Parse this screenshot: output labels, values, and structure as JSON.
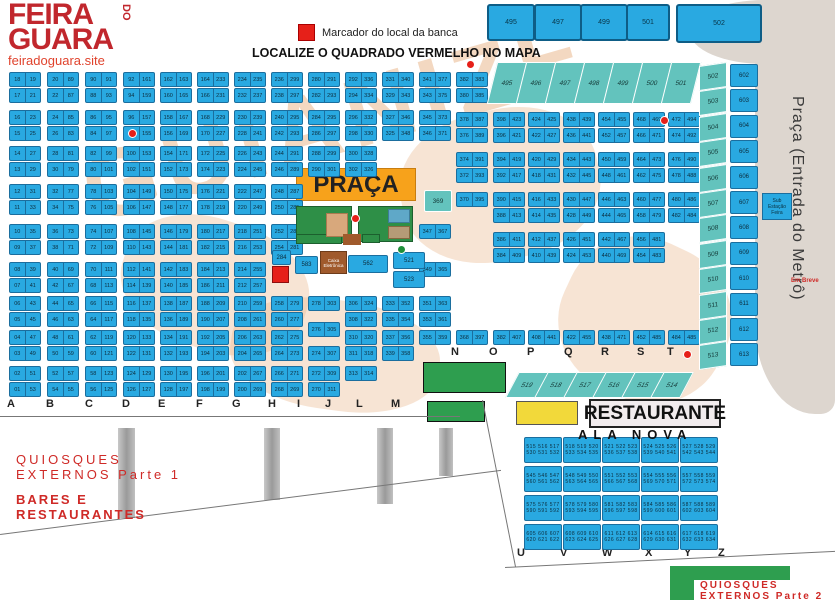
{
  "header": {
    "logo_line1": "FEIRA",
    "logo_do": "DO",
    "logo_line2": "GUARA",
    "site": "feiradoguara.site",
    "legend_label": "Marcador do local da banca",
    "title": "LOCALIZE O QUADRADO VERMELHO NO MAPA"
  },
  "colors": {
    "stall_blue": "#29a9e1",
    "teal": "#63c3bd",
    "orange": "#f7a21b",
    "green": "#2e9e4f",
    "yellow": "#f2d93a",
    "marker_red": "#e62019",
    "brown": "#a05a2c",
    "metro_gray": "#ddd6cf",
    "watermark_tan": "#e9b88e",
    "label_red": "#cf2a27"
  },
  "top_squares": [
    {
      "label": "495",
      "x": 487,
      "y": 4,
      "w": 44,
      "h": 33
    },
    {
      "label": "497",
      "x": 534,
      "y": 4,
      "w": 44,
      "h": 33
    },
    {
      "label": "499",
      "x": 580,
      "y": 4,
      "w": 44,
      "h": 33
    },
    {
      "label": "501",
      "x": 626,
      "y": 4,
      "w": 40,
      "h": 33
    },
    {
      "label": "502",
      "x": 676,
      "y": 4,
      "w": 82,
      "h": 35
    }
  ],
  "rows_y_left": [
    72,
    88,
    110,
    126,
    146,
    162,
    184,
    200,
    224,
    240,
    262,
    278,
    296,
    312,
    330,
    346,
    366,
    382
  ],
  "serpentine_columns": [
    {
      "name": "A",
      "x": 9,
      "left": {
        "from": 18,
        "step": -1
      },
      "right": {
        "from": 19,
        "step": 2
      }
    },
    {
      "name": "B",
      "x": 47,
      "left": {
        "from": 20,
        "step": 2
      },
      "right": {
        "from": 89,
        "step": -2
      }
    },
    {
      "name": "C",
      "x": 85,
      "left": {
        "from": 90,
        "step": -2
      },
      "right": {
        "from": 91,
        "step": 2
      }
    },
    {
      "name": "D",
      "x": 123,
      "left": {
        "from": 92,
        "step": 2
      },
      "right": {
        "from": 161,
        "step": -2
      }
    },
    {
      "name": "E",
      "x": 160,
      "left": {
        "from": 162,
        "step": -2
      },
      "right": {
        "from": 163,
        "step": 2
      }
    },
    {
      "name": "F",
      "x": 197,
      "left": {
        "from": 164,
        "step": 2
      },
      "right": {
        "from": 233,
        "step": -2
      }
    },
    {
      "name": "G",
      "x": 234,
      "left": {
        "from": 234,
        "step": -2
      },
      "right": {
        "from": 235,
        "step": 2
      }
    }
  ],
  "irregular_columns": [
    {
      "name": "H",
      "x": 271,
      "rows": [
        [
          72,
          "236",
          "299"
        ],
        [
          88,
          "238",
          "297"
        ],
        [
          110,
          "240",
          "295"
        ],
        [
          126,
          "242",
          "293"
        ],
        [
          146,
          "244",
          "291"
        ],
        [
          162,
          "246",
          "289"
        ],
        [
          184,
          "248",
          "287"
        ],
        [
          200,
          "250",
          "285"
        ],
        [
          224,
          "252",
          "283"
        ],
        [
          240,
          "254",
          "281"
        ],
        [
          296,
          "258",
          "279"
        ],
        [
          312,
          "260",
          "277"
        ],
        [
          330,
          "262",
          "275"
        ],
        [
          346,
          "264",
          "273"
        ],
        [
          366,
          "266",
          "271"
        ],
        [
          382,
          "268",
          "269"
        ]
      ]
    },
    {
      "name": "I",
      "x": 308,
      "rows": [
        [
          72,
          "280",
          "291"
        ],
        [
          88,
          "282",
          "293"
        ],
        [
          110,
          "284",
          "295"
        ],
        [
          126,
          "286",
          "297"
        ],
        [
          146,
          "288",
          "299"
        ],
        [
          162,
          "290",
          "301"
        ],
        [
          296,
          "278",
          "303"
        ],
        [
          322,
          "276",
          "305"
        ],
        [
          346,
          "274",
          "307"
        ],
        [
          366,
          "272",
          "309"
        ],
        [
          382,
          "270",
          "311"
        ]
      ]
    },
    {
      "name": "J",
      "x": 345,
      "rows": [
        [
          72,
          "292",
          "336"
        ],
        [
          88,
          "294",
          "334"
        ],
        [
          110,
          "296",
          "332"
        ],
        [
          126,
          "298",
          "330"
        ],
        [
          146,
          "300",
          "328"
        ],
        [
          162,
          "302",
          "326"
        ],
        [
          296,
          "306",
          "324"
        ],
        [
          312,
          "308",
          "322"
        ],
        [
          330,
          "310",
          "320"
        ],
        [
          346,
          "311",
          "318"
        ],
        [
          366,
          "313",
          "314"
        ]
      ]
    },
    {
      "name": "L",
      "x": 382,
      "rows": [
        [
          72,
          "331",
          "340"
        ],
        [
          88,
          "329",
          "343"
        ],
        [
          110,
          "327",
          "346"
        ],
        [
          126,
          "325",
          "348"
        ],
        [
          296,
          "333",
          "352"
        ],
        [
          312,
          "335",
          "354"
        ],
        [
          330,
          "337",
          "356"
        ],
        [
          346,
          "339",
          "358"
        ]
      ]
    },
    {
      "name": "M",
      "x": 419,
      "rows": [
        [
          72,
          "341",
          "377"
        ],
        [
          88,
          "343",
          "375"
        ],
        [
          110,
          "345",
          "373"
        ],
        [
          126,
          "346",
          "371"
        ],
        [
          224,
          "347",
          "367"
        ],
        [
          262,
          "349",
          "365"
        ],
        [
          296,
          "351",
          "363"
        ],
        [
          312,
          "353",
          "361"
        ],
        [
          330,
          "355",
          "359"
        ]
      ]
    },
    {
      "name": "N",
      "x": 456,
      "rows": [
        [
          72,
          "382",
          "383"
        ],
        [
          88,
          "380",
          "385"
        ],
        [
          112,
          "378",
          "387"
        ],
        [
          128,
          "376",
          "389"
        ],
        [
          152,
          "374",
          "391"
        ],
        [
          168,
          "372",
          "393"
        ],
        [
          192,
          "370",
          "395"
        ],
        [
          330,
          "368",
          "397"
        ]
      ]
    },
    {
      "name": "O",
      "x": 493,
      "rows": [
        [
          112,
          "398",
          "423"
        ],
        [
          128,
          "396",
          "421"
        ],
        [
          152,
          "394",
          "419"
        ],
        [
          168,
          "392",
          "417"
        ],
        [
          192,
          "390",
          "415"
        ],
        [
          208,
          "388",
          "413"
        ],
        [
          232,
          "386",
          "411"
        ],
        [
          248,
          "384",
          "409"
        ],
        [
          330,
          "382",
          "407"
        ]
      ]
    },
    {
      "name": "P",
      "x": 528,
      "rows": [
        [
          112,
          "424",
          "425"
        ],
        [
          128,
          "422",
          "427"
        ],
        [
          152,
          "420",
          "429"
        ],
        [
          168,
          "418",
          "431"
        ],
        [
          192,
          "416",
          "433"
        ],
        [
          208,
          "414",
          "435"
        ],
        [
          232,
          "412",
          "437"
        ],
        [
          248,
          "410",
          "439"
        ],
        [
          330,
          "408",
          "441"
        ]
      ]
    },
    {
      "name": "Q",
      "x": 563,
      "rows": [
        [
          112,
          "438",
          "439"
        ],
        [
          128,
          "436",
          "441"
        ],
        [
          152,
          "434",
          "443"
        ],
        [
          168,
          "432",
          "445"
        ],
        [
          192,
          "430",
          "447"
        ],
        [
          208,
          "428",
          "449"
        ],
        [
          232,
          "426",
          "451"
        ],
        [
          248,
          "424",
          "453"
        ],
        [
          330,
          "422",
          "455"
        ]
      ]
    },
    {
      "name": "R",
      "x": 598,
      "rows": [
        [
          112,
          "454",
          "455"
        ],
        [
          128,
          "452",
          "457"
        ],
        [
          152,
          "450",
          "459"
        ],
        [
          168,
          "448",
          "461"
        ],
        [
          192,
          "446",
          "463"
        ],
        [
          208,
          "444",
          "465"
        ],
        [
          232,
          "442",
          "467"
        ],
        [
          248,
          "440",
          "469"
        ],
        [
          330,
          "438",
          "471"
        ]
      ]
    },
    {
      "name": "S",
      "x": 633,
      "rows": [
        [
          112,
          "468",
          "469"
        ],
        [
          128,
          "466",
          "471"
        ],
        [
          152,
          "464",
          "473"
        ],
        [
          168,
          "462",
          "475"
        ],
        [
          192,
          "460",
          "477"
        ],
        [
          208,
          "458",
          "479"
        ],
        [
          232,
          "456",
          "481"
        ],
        [
          248,
          "454",
          "483"
        ],
        [
          330,
          "452",
          "485"
        ]
      ]
    },
    {
      "name": "T",
      "x": 668,
      "rows": [
        [
          112,
          "472",
          "494"
        ],
        [
          128,
          "474",
          "492"
        ],
        [
          152,
          "476",
          "490"
        ],
        [
          168,
          "478",
          "488"
        ],
        [
          192,
          "480",
          "486"
        ],
        [
          208,
          "482",
          "484"
        ],
        [
          330,
          "484",
          "485"
        ]
      ]
    }
  ],
  "singles": [
    {
      "label": "284",
      "x": 272,
      "y": 250,
      "w": 19,
      "h": 15,
      "kind": "blue"
    },
    {
      "label": "369",
      "x": 424,
      "y": 190,
      "w": 26,
      "h": 20,
      "kind": "teal"
    },
    {
      "label": "583",
      "x": 295,
      "y": 256,
      "w": 23,
      "h": 18,
      "kind": "blue"
    },
    {
      "label": "562",
      "x": 348,
      "y": 255,
      "w": 40,
      "h": 18,
      "kind": "blue"
    },
    {
      "label": "521",
      "x": 393,
      "y": 252,
      "w": 32,
      "h": 17,
      "kind": "blue"
    },
    {
      "label": "523",
      "x": 393,
      "y": 271,
      "w": 32,
      "h": 17,
      "kind": "blue"
    }
  ],
  "red_square_marker": {
    "x": 272,
    "y": 266,
    "w": 17,
    "h": 17
  },
  "praca": {
    "label": "PRAÇA",
    "box": {
      "x": 296,
      "y": 168,
      "w": 120,
      "h": 33
    },
    "green_boxes": [
      {
        "x": 296,
        "y": 206,
        "w": 56,
        "h": 37
      },
      {
        "x": 358,
        "y": 206,
        "w": 55,
        "h": 36
      },
      {
        "x": 296,
        "y": 234,
        "w": 46,
        "h": 10
      },
      {
        "x": 362,
        "y": 234,
        "w": 18,
        "h": 9
      }
    ],
    "tan_inner": {
      "x": 326,
      "y": 213,
      "w": 22,
      "h": 24
    },
    "teal_inner": {
      "x": 388,
      "y": 209,
      "w": 22,
      "h": 14
    },
    "gray_inner": {
      "x": 388,
      "y": 226,
      "w": 22,
      "h": 13
    },
    "brown_strip": {
      "x": 343,
      "y": 234,
      "w": 18,
      "h": 11
    },
    "caixa_box": {
      "label": "Caixa Eletrônica",
      "x": 320,
      "y": 252,
      "w": 26,
      "h": 22
    }
  },
  "teal_top_row": {
    "labels": [
      "495",
      "496",
      "497",
      "498",
      "499",
      "500",
      "501"
    ],
    "x0": 492,
    "dx": 29,
    "y": 62,
    "w": 28,
    "h": 40
  },
  "teal_bottom_row": {
    "labels": [
      "519",
      "518",
      "517",
      "516",
      "515",
      "514"
    ],
    "x0": 512,
    "dx": 29,
    "y": 372,
    "w": 28,
    "h": 24
  },
  "right_edge": {
    "teal_strip": {
      "labels": [
        "502",
        "503",
        "504",
        "505",
        "506",
        "507",
        "508",
        "509",
        "510",
        "511",
        "512",
        "513"
      ],
      "x": 699,
      "y0": 64,
      "dy": 25.4,
      "w": 26,
      "h": 23
    },
    "blue_strip": {
      "labels": [
        "602",
        "603",
        "604",
        "605",
        "606",
        "607",
        "608",
        "609",
        "610",
        "611",
        "612",
        "613"
      ],
      "x": 730,
      "y0": 64,
      "dy": 25.4,
      "w": 28,
      "h": 23
    },
    "sub_station": {
      "label": "Sub Estação Feira",
      "x": 762,
      "y": 193,
      "w": 28,
      "h": 26
    },
    "em_breve": {
      "label": "Em Breve",
      "x": 791,
      "y": 278
    },
    "metro_label": "Praça (Entrada do Metrô)"
  },
  "letters_am": {
    "y": 398,
    "items": [
      {
        "l": "A",
        "x": 7
      },
      {
        "l": "B",
        "x": 46
      },
      {
        "l": "C",
        "x": 85
      },
      {
        "l": "D",
        "x": 122
      },
      {
        "l": "E",
        "x": 158
      },
      {
        "l": "F",
        "x": 196
      },
      {
        "l": "G",
        "x": 232
      },
      {
        "l": "H",
        "x": 268
      },
      {
        "l": "I",
        "x": 297
      },
      {
        "l": "J",
        "x": 325
      },
      {
        "l": "L",
        "x": 356
      },
      {
        "l": "M",
        "x": 391
      }
    ]
  },
  "letters_nt": {
    "y": 346,
    "items": [
      {
        "l": "N",
        "x": 451
      },
      {
        "l": "O",
        "x": 489
      },
      {
        "l": "P",
        "x": 527
      },
      {
        "l": "Q",
        "x": 564
      },
      {
        "l": "R",
        "x": 601
      },
      {
        "l": "S",
        "x": 637
      },
      {
        "l": "T",
        "x": 667
      }
    ]
  },
  "letters_uz": {
    "y": 547,
    "items": [
      {
        "l": "U",
        "x": 517
      },
      {
        "l": "V",
        "x": 560
      },
      {
        "l": "W",
        "x": 602
      },
      {
        "l": "X",
        "x": 645
      },
      {
        "l": "Y",
        "x": 684
      },
      {
        "l": "Z",
        "x": 718
      }
    ]
  },
  "green_boxes": [
    {
      "x": 423,
      "y": 362,
      "w": 83,
      "h": 31
    },
    {
      "x": 427,
      "y": 401,
      "w": 58,
      "h": 21
    }
  ],
  "yellow_box": {
    "x": 516,
    "y": 401,
    "w": 62,
    "h": 24
  },
  "restaurante": {
    "label": "RESTAURANTE",
    "x": 589,
    "y": 399,
    "w": 132,
    "h": 29
  },
  "ala_nova": {
    "title": "ALA NOVA",
    "title_x": 578,
    "title_y": 427,
    "start": 515,
    "cols": 5,
    "groups": 4,
    "per_row": 3,
    "x0": 524,
    "dx": 39,
    "y0": 437,
    "dy": 29,
    "w": 36,
    "h": 24
  },
  "quiosques1": {
    "line1": "QUIOSQUES",
    "line2": "EXTERNOS Parte 1",
    "x": 16,
    "y": 452
  },
  "bares": {
    "line1": "BARES E",
    "line2": "RESTAURANTES",
    "x": 16,
    "y": 492
  },
  "quiosques2": {
    "line1": "QUIOSQUES",
    "line2": "EXTERNOS Parte 2",
    "bar": {
      "x": 670,
      "y": 566,
      "w": 120,
      "h": 14
    },
    "leg": {
      "x": 670,
      "y": 566,
      "w": 24,
      "h": 34
    },
    "tx": 700,
    "ty": 580
  },
  "pillars": [
    {
      "x": 118,
      "y": 428,
      "w": 17,
      "h": 90
    },
    {
      "x": 264,
      "y": 428,
      "w": 16,
      "h": 72
    },
    {
      "x": 377,
      "y": 428,
      "w": 16,
      "h": 76
    },
    {
      "x": 439,
      "y": 428,
      "w": 14,
      "h": 48
    }
  ],
  "lines": [
    {
      "x": 0,
      "y": 416,
      "len": 460,
      "ang": 0
    },
    {
      "x": 0,
      "y": 534,
      "len": 505,
      "ang": -7.3
    },
    {
      "x": 483,
      "y": 400,
      "len": 170,
      "ang": 78.8
    },
    {
      "x": 505,
      "y": 567,
      "len": 331,
      "ang": -2.8
    }
  ],
  "markers_red": [
    {
      "x": 128,
      "y": 129
    },
    {
      "x": 466,
      "y": 60
    },
    {
      "x": 660,
      "y": 116
    },
    {
      "x": 683,
      "y": 350
    },
    {
      "x": 351,
      "y": 214
    }
  ],
  "markers_green": [
    {
      "x": 397,
      "y": 245
    },
    {
      "x": 334,
      "y": 256
    }
  ],
  "watermark": "GUIANIZE"
}
